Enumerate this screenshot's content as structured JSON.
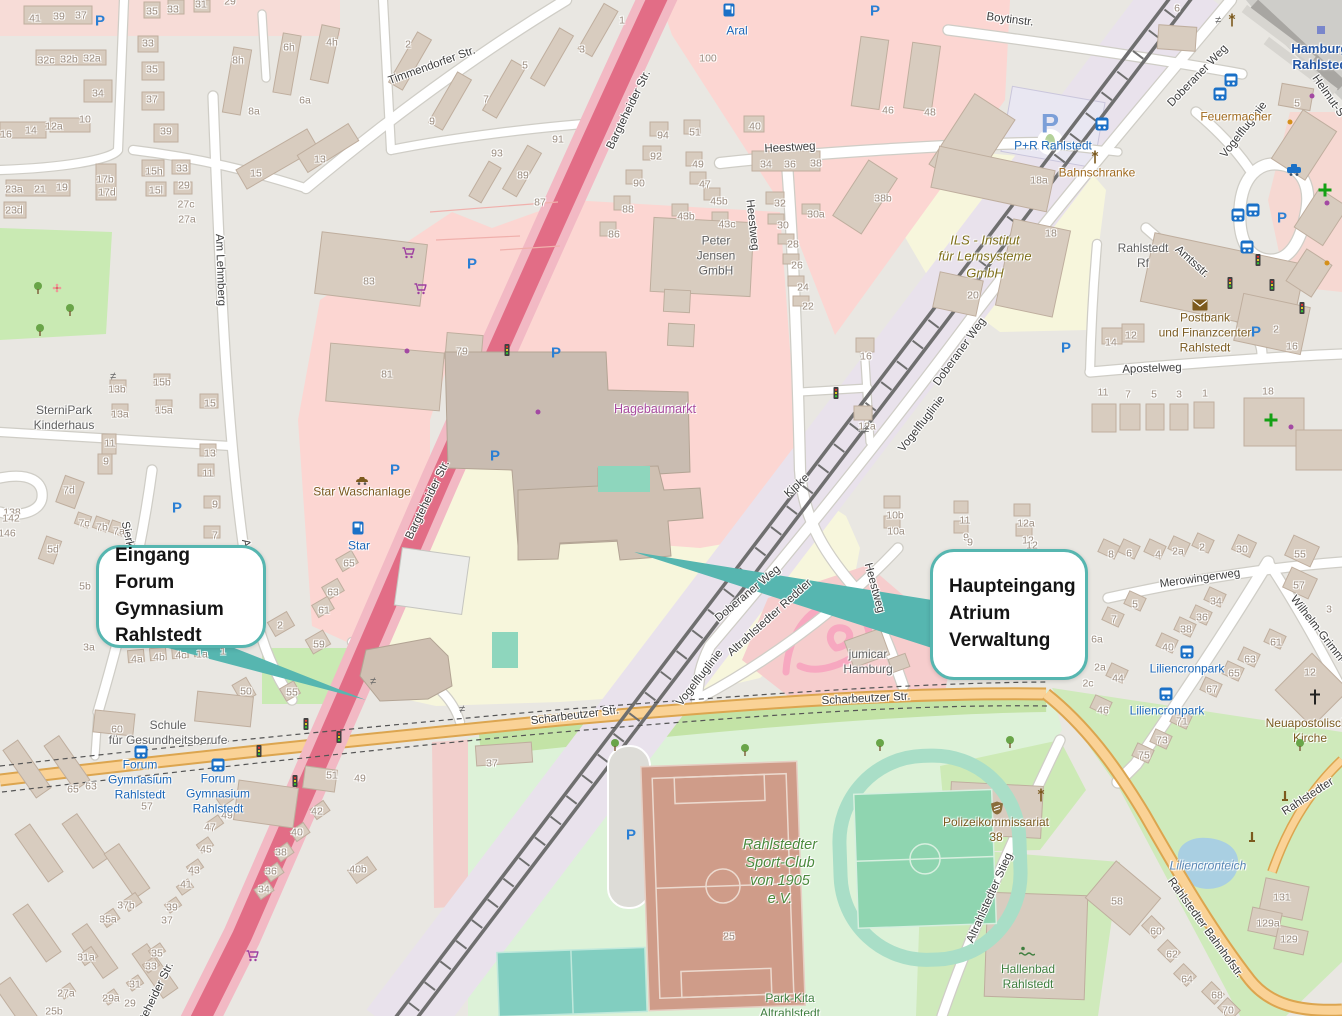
{
  "callouts": [
    {
      "lines": "Eingang\nForum Gymnasium\nRahlstedt",
      "x": 96,
      "y": 545,
      "w": 170,
      "h": 103
    },
    {
      "lines": "Haupteingang\nAtrium\nVerwaltung",
      "x": 930,
      "y": 549,
      "w": 158,
      "h": 131
    }
  ],
  "colors": {
    "accent_teal": "#56b6b0",
    "trunk_road": "#e26d86",
    "secondary_road": "#fad296",
    "retail_area": "#fcd6d2",
    "school_area": "#f7f6dc",
    "park_area": "#c9eab3",
    "water": "#a9cfe2",
    "railway_land": "#e9e2ec",
    "building": "#d8ccbf",
    "transit_blue": "#1a66b8",
    "poi_brown": "#7a5a20",
    "poi_green": "#3e7e3e",
    "poi_purple": "#a84a9f"
  },
  "street_labels": [
    {
      "text": "Timmendorfer Str.",
      "x": 432,
      "y": 66,
      "rot": -20
    },
    {
      "text": "Bargteheider Str.",
      "x": 629,
      "y": 110,
      "rot": -64
    },
    {
      "text": "Bargteheider Str.",
      "x": 428,
      "y": 500,
      "rot": -64
    },
    {
      "text": "Bargteheider Str.",
      "x": 152,
      "y": 1002,
      "rot": -64
    },
    {
      "text": "Am Lehmberg",
      "x": 220,
      "y": 270,
      "rot": 88
    },
    {
      "text": "Am Lehmberg",
      "x": 251,
      "y": 575,
      "rot": 80
    },
    {
      "text": "Sierksdorfer Str.",
      "x": 133,
      "y": 562,
      "rot": 78
    },
    {
      "text": "Heestweg",
      "x": 790,
      "y": 148,
      "rot": -3
    },
    {
      "text": "Heestweg",
      "x": 752,
      "y": 225,
      "rot": 84
    },
    {
      "text": "Heestweg",
      "x": 874,
      "y": 588,
      "rot": 75
    },
    {
      "text": "Doberaner Weg",
      "x": 1198,
      "y": 76,
      "rot": -46
    },
    {
      "text": "Doberaner Weg",
      "x": 960,
      "y": 352,
      "rot": -54
    },
    {
      "text": "Doberaner Weg",
      "x": 748,
      "y": 594,
      "rot": -40
    },
    {
      "text": "Boytinstr.",
      "x": 1010,
      "y": 20,
      "rot": 7
    },
    {
      "text": "Scharbeutzer Str.",
      "x": 575,
      "y": 716,
      "rot": -7
    },
    {
      "text": "Scharbeutzer Str.",
      "x": 866,
      "y": 699,
      "rot": -3
    },
    {
      "text": "Rahlstedter Bahnhofstr.",
      "x": 1205,
      "y": 928,
      "rot": 54
    },
    {
      "text": "Rahlstedter",
      "x": 1308,
      "y": 797,
      "rot": -33
    },
    {
      "text": "Altrahlstedter Stieg",
      "x": 990,
      "y": 898,
      "rot": -66
    },
    {
      "text": "Altrahlstedter Redder",
      "x": 770,
      "y": 618,
      "rot": -42
    },
    {
      "text": "Vogelfluglinie",
      "x": 1244,
      "y": 130,
      "rot": -52
    },
    {
      "text": "Vogelfluglinie",
      "x": 922,
      "y": 424,
      "rot": -52
    },
    {
      "text": "Vogelfluglinie",
      "x": 700,
      "y": 678,
      "rot": -52
    },
    {
      "text": "Apostelweg",
      "x": 1152,
      "y": 369,
      "rot": -2
    },
    {
      "text": "Merowingerweg",
      "x": 1200,
      "y": 579,
      "rot": -8
    },
    {
      "text": "Amtsstr.",
      "x": 1192,
      "y": 262,
      "rot": 42
    },
    {
      "text": "Wilhelm-Grimm-",
      "x": 1318,
      "y": 630,
      "rot": 52
    },
    {
      "text": "Helmut-S",
      "x": 1328,
      "y": 96,
      "rot": 55
    },
    {
      "text": "Kipke",
      "x": 797,
      "y": 486,
      "rot": -42
    }
  ],
  "poi_labels": [
    {
      "text": "Aral",
      "x": 737,
      "y": 31,
      "style": "transit"
    },
    {
      "text": "Star",
      "x": 359,
      "y": 546,
      "style": "transit"
    },
    {
      "text": "Star Waschanlage",
      "x": 362,
      "y": 492,
      "style": "brown"
    },
    {
      "text": "Peter\nJensen\nGmbH",
      "x": 716,
      "y": 256,
      "style": "gray"
    },
    {
      "text": "Hagebaumarkt",
      "x": 655,
      "y": 410,
      "style": "purple"
    },
    {
      "text": "ILS - Institut\nfür Lernsysteme\nGmbH",
      "x": 985,
      "y": 257,
      "style": "olive"
    },
    {
      "text": "P+R Rahlstedt",
      "x": 1053,
      "y": 146,
      "style": "transit"
    },
    {
      "text": "Bahnschranke",
      "x": 1097,
      "y": 173,
      "style": "orange"
    },
    {
      "text": "Feuermacher",
      "x": 1236,
      "y": 117,
      "style": "orange"
    },
    {
      "text": "Hamburg-\nRahlstedt",
      "x": 1322,
      "y": 57,
      "style": "station"
    },
    {
      "text": "Rahlstedt\nRf",
      "x": 1143,
      "y": 256,
      "style": "gray"
    },
    {
      "text": "Postbank\nund Finanzcenter\nRahlstedt",
      "x": 1205,
      "y": 333,
      "style": "brown"
    },
    {
      "text": "SterniPark\nKinderhaus",
      "x": 64,
      "y": 418,
      "style": "gray"
    },
    {
      "text": "Schule\nfür Gesundheitsberufe",
      "x": 168,
      "y": 733,
      "style": "gray"
    },
    {
      "text": "Forum\nGymnasium\nRahlstedt",
      "x": 140,
      "y": 780,
      "style": "transit"
    },
    {
      "text": "Forum\nGymnasium\nRahlstedt",
      "x": 218,
      "y": 794,
      "style": "transit"
    },
    {
      "text": "Rahlstedter\nSport-Club\nvon 1905\ne.V.",
      "x": 780,
      "y": 872,
      "style": "green-italic"
    },
    {
      "text": "Polizeikommissariat\n38",
      "x": 996,
      "y": 830,
      "style": "brown"
    },
    {
      "text": "Hallenbad\nRahlstedt",
      "x": 1028,
      "y": 977,
      "style": "green"
    },
    {
      "text": "Neuapostolische\nKirche",
      "x": 1310,
      "y": 731,
      "style": "brown"
    },
    {
      "text": "Liliencronteich",
      "x": 1208,
      "y": 866,
      "style": "water"
    },
    {
      "text": "Liliencronpark",
      "x": 1187,
      "y": 669,
      "style": "transit"
    },
    {
      "text": "Liliencronpark",
      "x": 1167,
      "y": 711,
      "style": "transit"
    },
    {
      "text": "jumicar\nHamburg",
      "x": 868,
      "y": 662,
      "style": "gray"
    },
    {
      "text": "Park-Kita\nAltrahlstedt",
      "x": 790,
      "y": 1006,
      "style": "green"
    }
  ],
  "house_numbers": [
    [
      35,
      19,
      "41"
    ],
    [
      59,
      17,
      "39"
    ],
    [
      81,
      16,
      "37"
    ],
    [
      46,
      61,
      "32c"
    ],
    [
      69,
      60,
      "32b"
    ],
    [
      92,
      59,
      "32a"
    ],
    [
      98,
      94,
      "34"
    ],
    [
      6,
      135,
      "16"
    ],
    [
      31,
      131,
      "14"
    ],
    [
      54,
      127,
      "12a"
    ],
    [
      85,
      120,
      "10"
    ],
    [
      14,
      190,
      "23a"
    ],
    [
      40,
      190,
      "21"
    ],
    [
      62,
      188,
      "19"
    ],
    [
      14,
      211,
      "23d"
    ],
    [
      105,
      180,
      "17b"
    ],
    [
      107,
      193,
      "17d"
    ],
    [
      152,
      12,
      "35"
    ],
    [
      173,
      10,
      "33"
    ],
    [
      201,
      5,
      "31"
    ],
    [
      230,
      2,
      "29"
    ],
    [
      148,
      44,
      "33"
    ],
    [
      152,
      70,
      "35"
    ],
    [
      152,
      100,
      "37"
    ],
    [
      166,
      132,
      "39"
    ],
    [
      154,
      172,
      "15h"
    ],
    [
      156,
      191,
      "15l"
    ],
    [
      182,
      169,
      "33"
    ],
    [
      184,
      186,
      "29"
    ],
    [
      186,
      205,
      "27c"
    ],
    [
      187,
      220,
      "27a"
    ],
    [
      238,
      61,
      "8h"
    ],
    [
      254,
      112,
      "8a"
    ],
    [
      289,
      48,
      "6h"
    ],
    [
      305,
      101,
      "6a"
    ],
    [
      332,
      43,
      "4h"
    ],
    [
      256,
      174,
      "15"
    ],
    [
      320,
      160,
      "13"
    ],
    [
      408,
      45,
      "2"
    ],
    [
      622,
      21,
      "1"
    ],
    [
      582,
      50,
      "3"
    ],
    [
      525,
      66,
      "5"
    ],
    [
      486,
      100,
      "7"
    ],
    [
      432,
      122,
      "9"
    ],
    [
      558,
      140,
      "91"
    ],
    [
      497,
      154,
      "93"
    ],
    [
      523,
      176,
      "89"
    ],
    [
      540,
      203,
      "87"
    ],
    [
      708,
      59,
      "100"
    ],
    [
      755,
      127,
      "40"
    ],
    [
      663,
      136,
      "94"
    ],
    [
      656,
      157,
      "92"
    ],
    [
      695,
      133,
      "51"
    ],
    [
      698,
      165,
      "49"
    ],
    [
      639,
      184,
      "90"
    ],
    [
      628,
      210,
      "88"
    ],
    [
      614,
      235,
      "86"
    ],
    [
      705,
      185,
      "47"
    ],
    [
      719,
      202,
      "45b"
    ],
    [
      686,
      217,
      "43b"
    ],
    [
      727,
      225,
      "43c"
    ],
    [
      766,
      165,
      "34"
    ],
    [
      790,
      165,
      "36"
    ],
    [
      816,
      164,
      "38"
    ],
    [
      780,
      204,
      "32"
    ],
    [
      816,
      215,
      "30a"
    ],
    [
      783,
      226,
      "30"
    ],
    [
      793,
      245,
      "28"
    ],
    [
      797,
      266,
      "26"
    ],
    [
      803,
      288,
      "24"
    ],
    [
      808,
      307,
      "22"
    ],
    [
      888,
      111,
      "46"
    ],
    [
      930,
      113,
      "48"
    ],
    [
      883,
      199,
      "38b"
    ],
    [
      1039,
      181,
      "18a"
    ],
    [
      1051,
      234,
      "18"
    ],
    [
      973,
      296,
      "20"
    ],
    [
      369,
      282,
      "83"
    ],
    [
      387,
      375,
      "81"
    ],
    [
      462,
      352,
      "79"
    ],
    [
      866,
      357,
      "16"
    ],
    [
      867,
      427,
      "12a"
    ],
    [
      895,
      516,
      "10b"
    ],
    [
      896,
      532,
      "10a"
    ],
    [
      965,
      521,
      "11"
    ],
    [
      966,
      538,
      "9"
    ],
    [
      1026,
      524,
      "12a"
    ],
    [
      1028,
      541,
      "12"
    ],
    [
      117,
      390,
      "13b"
    ],
    [
      120,
      415,
      "13a"
    ],
    [
      162,
      383,
      "15b"
    ],
    [
      164,
      411,
      "15a"
    ],
    [
      210,
      404,
      "15"
    ],
    [
      110,
      444,
      "11"
    ],
    [
      106,
      462,
      "9"
    ],
    [
      210,
      454,
      "13"
    ],
    [
      208,
      474,
      "11"
    ],
    [
      215,
      505,
      "9"
    ],
    [
      215,
      536,
      "7"
    ],
    [
      69,
      491,
      "7d"
    ],
    [
      84,
      524,
      "7c"
    ],
    [
      102,
      528,
      "7b"
    ],
    [
      119,
      532,
      "7a"
    ],
    [
      53,
      550,
      "5d"
    ],
    [
      12,
      513,
      "138"
    ],
    [
      11,
      519,
      "142"
    ],
    [
      7,
      534,
      "146"
    ],
    [
      217,
      567,
      "5"
    ],
    [
      85,
      587,
      "5b"
    ],
    [
      89,
      648,
      "3a"
    ],
    [
      137,
      660,
      "4a"
    ],
    [
      159,
      658,
      "4b"
    ],
    [
      181,
      656,
      "4c"
    ],
    [
      202,
      655,
      "1a"
    ],
    [
      223,
      652,
      "1"
    ],
    [
      223,
      620,
      "1b"
    ],
    [
      280,
      626,
      "2"
    ],
    [
      319,
      645,
      "59"
    ],
    [
      349,
      564,
      "65"
    ],
    [
      333,
      593,
      "63"
    ],
    [
      324,
      611,
      "61"
    ],
    [
      292,
      693,
      "55"
    ],
    [
      246,
      692,
      "50"
    ],
    [
      117,
      730,
      "60"
    ],
    [
      73,
      790,
      "65"
    ],
    [
      91,
      787,
      "63"
    ],
    [
      147,
      807,
      "57"
    ],
    [
      332,
      776,
      "51"
    ],
    [
      360,
      779,
      "49"
    ],
    [
      317,
      812,
      "42"
    ],
    [
      297,
      833,
      "40"
    ],
    [
      281,
      853,
      "38"
    ],
    [
      271,
      872,
      "36"
    ],
    [
      264,
      890,
      "34"
    ],
    [
      358,
      870,
      "40b"
    ],
    [
      227,
      816,
      "49"
    ],
    [
      210,
      828,
      "47"
    ],
    [
      206,
      850,
      "45"
    ],
    [
      194,
      871,
      "43"
    ],
    [
      186,
      885,
      "41"
    ],
    [
      172,
      908,
      "39"
    ],
    [
      167,
      921,
      "37"
    ],
    [
      126,
      906,
      "37b"
    ],
    [
      108,
      920,
      "35a"
    ],
    [
      86,
      958,
      "31a"
    ],
    [
      157,
      954,
      "35"
    ],
    [
      151,
      967,
      "33"
    ],
    [
      135,
      985,
      "31"
    ],
    [
      111,
      999,
      "29a"
    ],
    [
      130,
      1004,
      "29"
    ],
    [
      66,
      994,
      "27a"
    ],
    [
      54,
      1012,
      "25b"
    ],
    [
      492,
      764,
      "37"
    ],
    [
      729,
      937,
      "25"
    ],
    [
      963,
      655,
      "10a"
    ],
    [
      954,
      670,
      "10"
    ],
    [
      987,
      669,
      "8"
    ],
    [
      1010,
      667,
      "6"
    ],
    [
      1100,
      668,
      "2a"
    ],
    [
      1088,
      684,
      "2c"
    ],
    [
      970,
      543,
      "9"
    ],
    [
      1032,
      546,
      "12"
    ],
    [
      1117,
      902,
      "58"
    ],
    [
      1156,
      932,
      "60"
    ],
    [
      1172,
      955,
      "62"
    ],
    [
      1187,
      980,
      "64"
    ],
    [
      1217,
      996,
      "68"
    ],
    [
      1228,
      1011,
      "70"
    ],
    [
      1282,
      898,
      "131"
    ],
    [
      1268,
      924,
      "129a"
    ],
    [
      1289,
      940,
      "129"
    ],
    [
      1111,
      343,
      "14"
    ],
    [
      1131,
      336,
      "12"
    ],
    [
      1103,
      393,
      "11"
    ],
    [
      1128,
      395,
      "7"
    ],
    [
      1154,
      395,
      "5"
    ],
    [
      1179,
      395,
      "3"
    ],
    [
      1205,
      394,
      "1"
    ],
    [
      1276,
      330,
      "2"
    ],
    [
      1292,
      347,
      "16"
    ],
    [
      1268,
      392,
      "18"
    ],
    [
      1177,
      9,
      "6"
    ],
    [
      1297,
      104,
      "5"
    ],
    [
      1111,
      555,
      "8"
    ],
    [
      1129,
      554,
      "6"
    ],
    [
      1158,
      555,
      "4"
    ],
    [
      1178,
      552,
      "2a"
    ],
    [
      1202,
      548,
      "2"
    ],
    [
      1242,
      550,
      "30"
    ],
    [
      1300,
      555,
      "55"
    ],
    [
      1299,
      586,
      "57"
    ],
    [
      1329,
      610,
      "3"
    ],
    [
      1135,
      605,
      "5"
    ],
    [
      1114,
      620,
      "7"
    ],
    [
      1097,
      640,
      "6a"
    ],
    [
      1216,
      602,
      "34"
    ],
    [
      1202,
      618,
      "36"
    ],
    [
      1186,
      630,
      "38"
    ],
    [
      1168,
      648,
      "40"
    ],
    [
      1118,
      679,
      "44"
    ],
    [
      1103,
      711,
      "46"
    ],
    [
      1276,
      643,
      "61"
    ],
    [
      1250,
      660,
      "63"
    ],
    [
      1234,
      674,
      "65"
    ],
    [
      1212,
      690,
      "67"
    ],
    [
      1182,
      722,
      "71"
    ],
    [
      1162,
      741,
      "73"
    ],
    [
      1144,
      756,
      "75"
    ],
    [
      1310,
      673,
      "12"
    ]
  ],
  "icons": [
    [
      "parking",
      100,
      21
    ],
    [
      "parking",
      875,
      11
    ],
    [
      "parking",
      472,
      264
    ],
    [
      "parking",
      556,
      353
    ],
    [
      "parking",
      495,
      456
    ],
    [
      "parking",
      395,
      470
    ],
    [
      "parking",
      177,
      508
    ],
    [
      "parking",
      1256,
      332
    ],
    [
      "parking",
      1066,
      348
    ],
    [
      "parking",
      1018,
      673
    ],
    [
      "parking",
      631,
      835
    ],
    [
      "parking",
      1282,
      218
    ],
    [
      "parkride",
      1050,
      124
    ],
    [
      "fuel",
      729,
      10
    ],
    [
      "fuel",
      358,
      528
    ],
    [
      "cart",
      408,
      253
    ],
    [
      "cart",
      420,
      289
    ],
    [
      "cart",
      252,
      956
    ],
    [
      "bus",
      141,
      752
    ],
    [
      "bus",
      218,
      765
    ],
    [
      "bus",
      1231,
      80
    ],
    [
      "bus",
      1220,
      94
    ],
    [
      "bus",
      1238,
      215
    ],
    [
      "bus",
      1253,
      210
    ],
    [
      "bus",
      1247,
      247
    ],
    [
      "bus",
      1187,
      652
    ],
    [
      "bus",
      1166,
      694
    ],
    [
      "bus",
      1102,
      124
    ],
    [
      "taxi",
      1294,
      170
    ],
    [
      "traffic-light",
      259,
      751
    ],
    [
      "traffic-light",
      306,
      724
    ],
    [
      "traffic-light",
      339,
      737
    ],
    [
      "traffic-light",
      295,
      781
    ],
    [
      "traffic-light",
      507,
      350
    ],
    [
      "traffic-light",
      1230,
      283
    ],
    [
      "traffic-light",
      1258,
      260
    ],
    [
      "traffic-light",
      1272,
      285
    ],
    [
      "traffic-light",
      1302,
      308
    ],
    [
      "traffic-light",
      836,
      393
    ],
    [
      "tree",
      38,
      288
    ],
    [
      "tree",
      70,
      310
    ],
    [
      "tree",
      40,
      330
    ],
    [
      "tree",
      615,
      745
    ],
    [
      "tree",
      745,
      750
    ],
    [
      "tree",
      880,
      745
    ],
    [
      "tree",
      1010,
      742
    ],
    [
      "tree",
      1300,
      745
    ],
    [
      "flower",
      57,
      288
    ],
    [
      "police",
      997,
      808
    ],
    [
      "swimmer",
      1027,
      951
    ],
    [
      "monument",
      1285,
      797
    ],
    [
      "monument",
      1252,
      838
    ],
    [
      "gate",
      1095,
      157
    ],
    [
      "gate",
      1232,
      20
    ],
    [
      "gate",
      1041,
      795
    ],
    [
      "wash",
      362,
      480
    ],
    [
      "station-marker",
      1321,
      30
    ],
    [
      "envelope",
      1200,
      305
    ],
    [
      "pharmacy",
      1325,
      190
    ],
    [
      "pharmacy",
      1271,
      420
    ],
    [
      "church",
      1315,
      697
    ],
    [
      "barrier",
      113,
      377
    ],
    [
      "barrier",
      373,
      682
    ],
    [
      "barrier",
      462,
      710
    ],
    [
      "barrier",
      866,
      431
    ],
    [
      "barrier",
      1218,
      21
    ],
    [
      "dot-purple",
      538,
      412
    ],
    [
      "dot-purple",
      407,
      351
    ],
    [
      "dot-purple",
      1312,
      96
    ],
    [
      "dot-purple",
      1327,
      203
    ],
    [
      "dot-purple",
      1291,
      427
    ],
    [
      "dot-orange",
      1290,
      122
    ],
    [
      "dot-orange",
      1327,
      263
    ]
  ]
}
